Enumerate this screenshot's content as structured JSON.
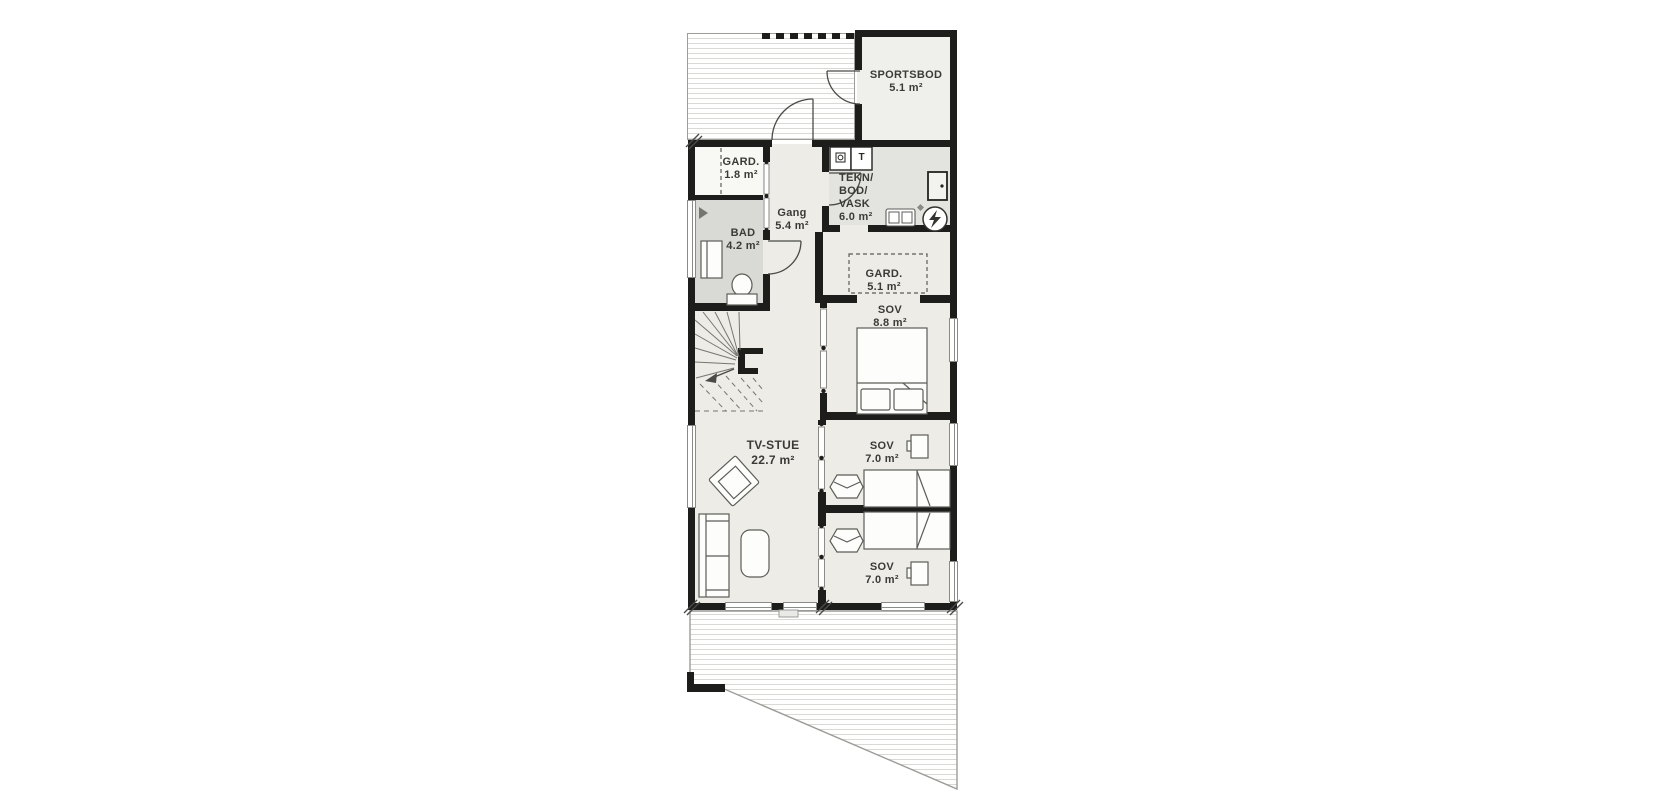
{
  "plan": {
    "type": "floor-plan",
    "language": "Norwegian",
    "colors": {
      "wall": "#1d1d1b",
      "floor": "#edece6",
      "floor_bath": "#d9d9d6",
      "floor_tech": "#e3e3df",
      "floor_closet": "#f8f8f5",
      "floor_sportsbod": "#efefeb",
      "deck_stripe": "#d9d9d6",
      "outline": "#9c9c99",
      "label_text": "#3a3a37"
    }
  },
  "rooms": [
    {
      "id": "sportsbod",
      "name": "SPORTSBOD",
      "area": "5.1 m²"
    },
    {
      "id": "gard-entry",
      "name": "GARD.",
      "area": "1.8 m²"
    },
    {
      "id": "bad",
      "name": "BAD",
      "area": "4.2 m²"
    },
    {
      "id": "gang",
      "name": "Gang",
      "area": "5.4 m²"
    },
    {
      "id": "tekn-bod-vask",
      "lines": [
        "TEKN/",
        "BOD/",
        "VASK",
        "6.0 m²"
      ]
    },
    {
      "id": "gard-sov",
      "name": "GARD.",
      "area": "5.1 m²"
    },
    {
      "id": "sov-1",
      "name": "SOV",
      "area": "8.8 m²"
    },
    {
      "id": "tv-stue",
      "name": "TV-STUE",
      "area": "22.7 m²"
    },
    {
      "id": "sov-2",
      "name": "SOV",
      "area": "7.0 m²"
    },
    {
      "id": "sov-3",
      "name": "SOV",
      "area": "7.0 m²"
    }
  ],
  "appliances": {
    "dryer_label": "T"
  }
}
